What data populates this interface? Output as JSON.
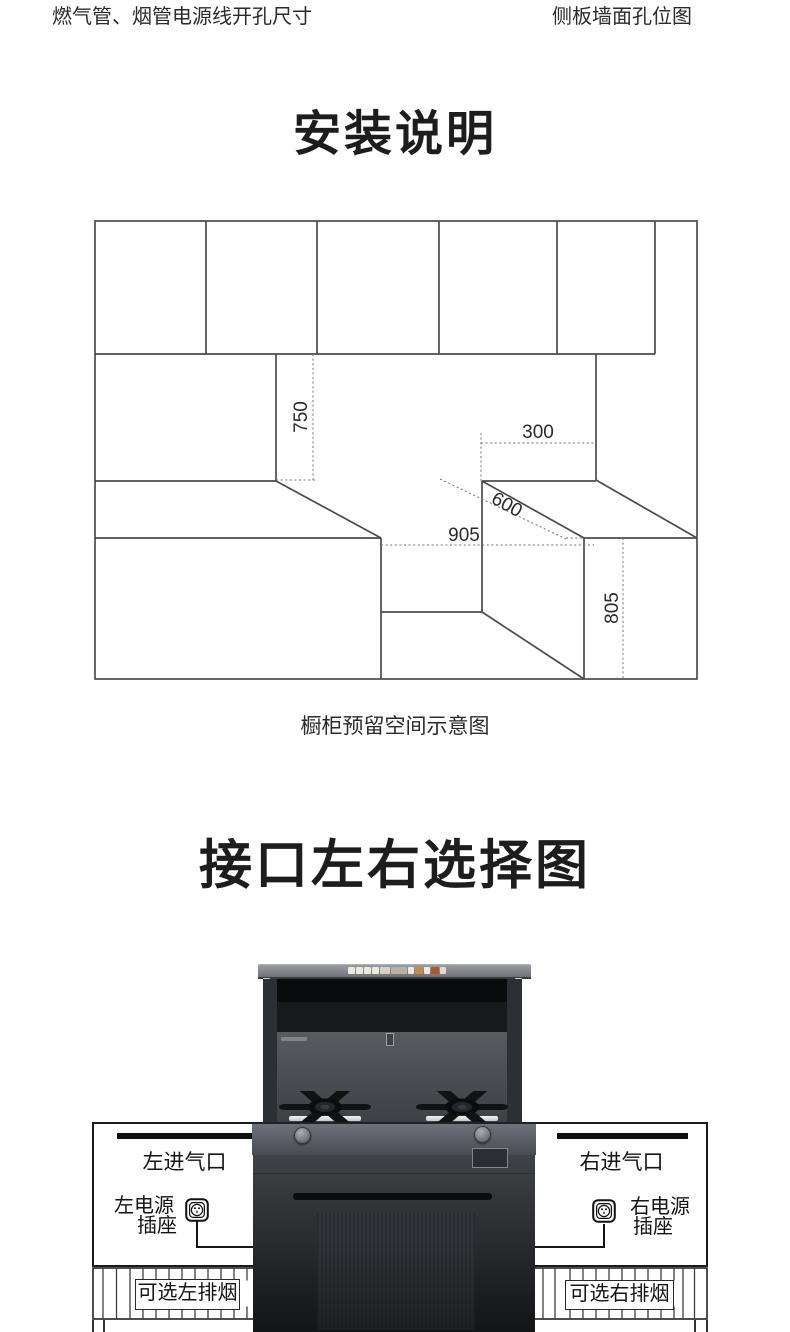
{
  "header": {
    "left_caption": "燃气管、烟管电源线开孔尺寸",
    "right_caption": "侧板墙面孔位图"
  },
  "section_install": {
    "title": "安装说明",
    "caption": "橱柜预留空间示意图",
    "diagram": {
      "name": "cabinet-reserved-space-diagram",
      "dimensions": {
        "d750": "750",
        "d300": "300",
        "d600": "600",
        "d905": "905",
        "d805": "805"
      }
    }
  },
  "section_interface": {
    "title": "接口左右选择图",
    "left": {
      "inlet": "左进气口",
      "power_line1": "左电源",
      "power_line2": "插座",
      "exhaust": "可选左排烟"
    },
    "right": {
      "inlet": "右进气口",
      "power_line1": "右电源",
      "power_line2": "插座",
      "exhaust": "可选右排烟"
    },
    "icons": {
      "left_socket": "power-socket-icon",
      "right_socket": "power-socket-icon"
    }
  },
  "product": {
    "hood_strip_colors": [
      "#ece9e2",
      "#ece9e2",
      "#ece9e2",
      "#ece9e2",
      "#d8d2c6",
      "#b9b2a4",
      "#ece9e2",
      "#c98a45",
      "#ece9e2",
      "#b0542b",
      "#e0dbd2"
    ],
    "hood_strip_widths": [
      7,
      7,
      7,
      7,
      10,
      16,
      6,
      8,
      6,
      8,
      6
    ]
  },
  "colors": {
    "line": "#4b4b4b",
    "dotted": "#707070",
    "text": "#2d2d2d",
    "panel_border": "#1b1b1b",
    "product_dark": "#2a2c30",
    "deck_gray": "#5c6066",
    "accent_orange": "#c98a45",
    "accent_red": "#b0542b"
  }
}
